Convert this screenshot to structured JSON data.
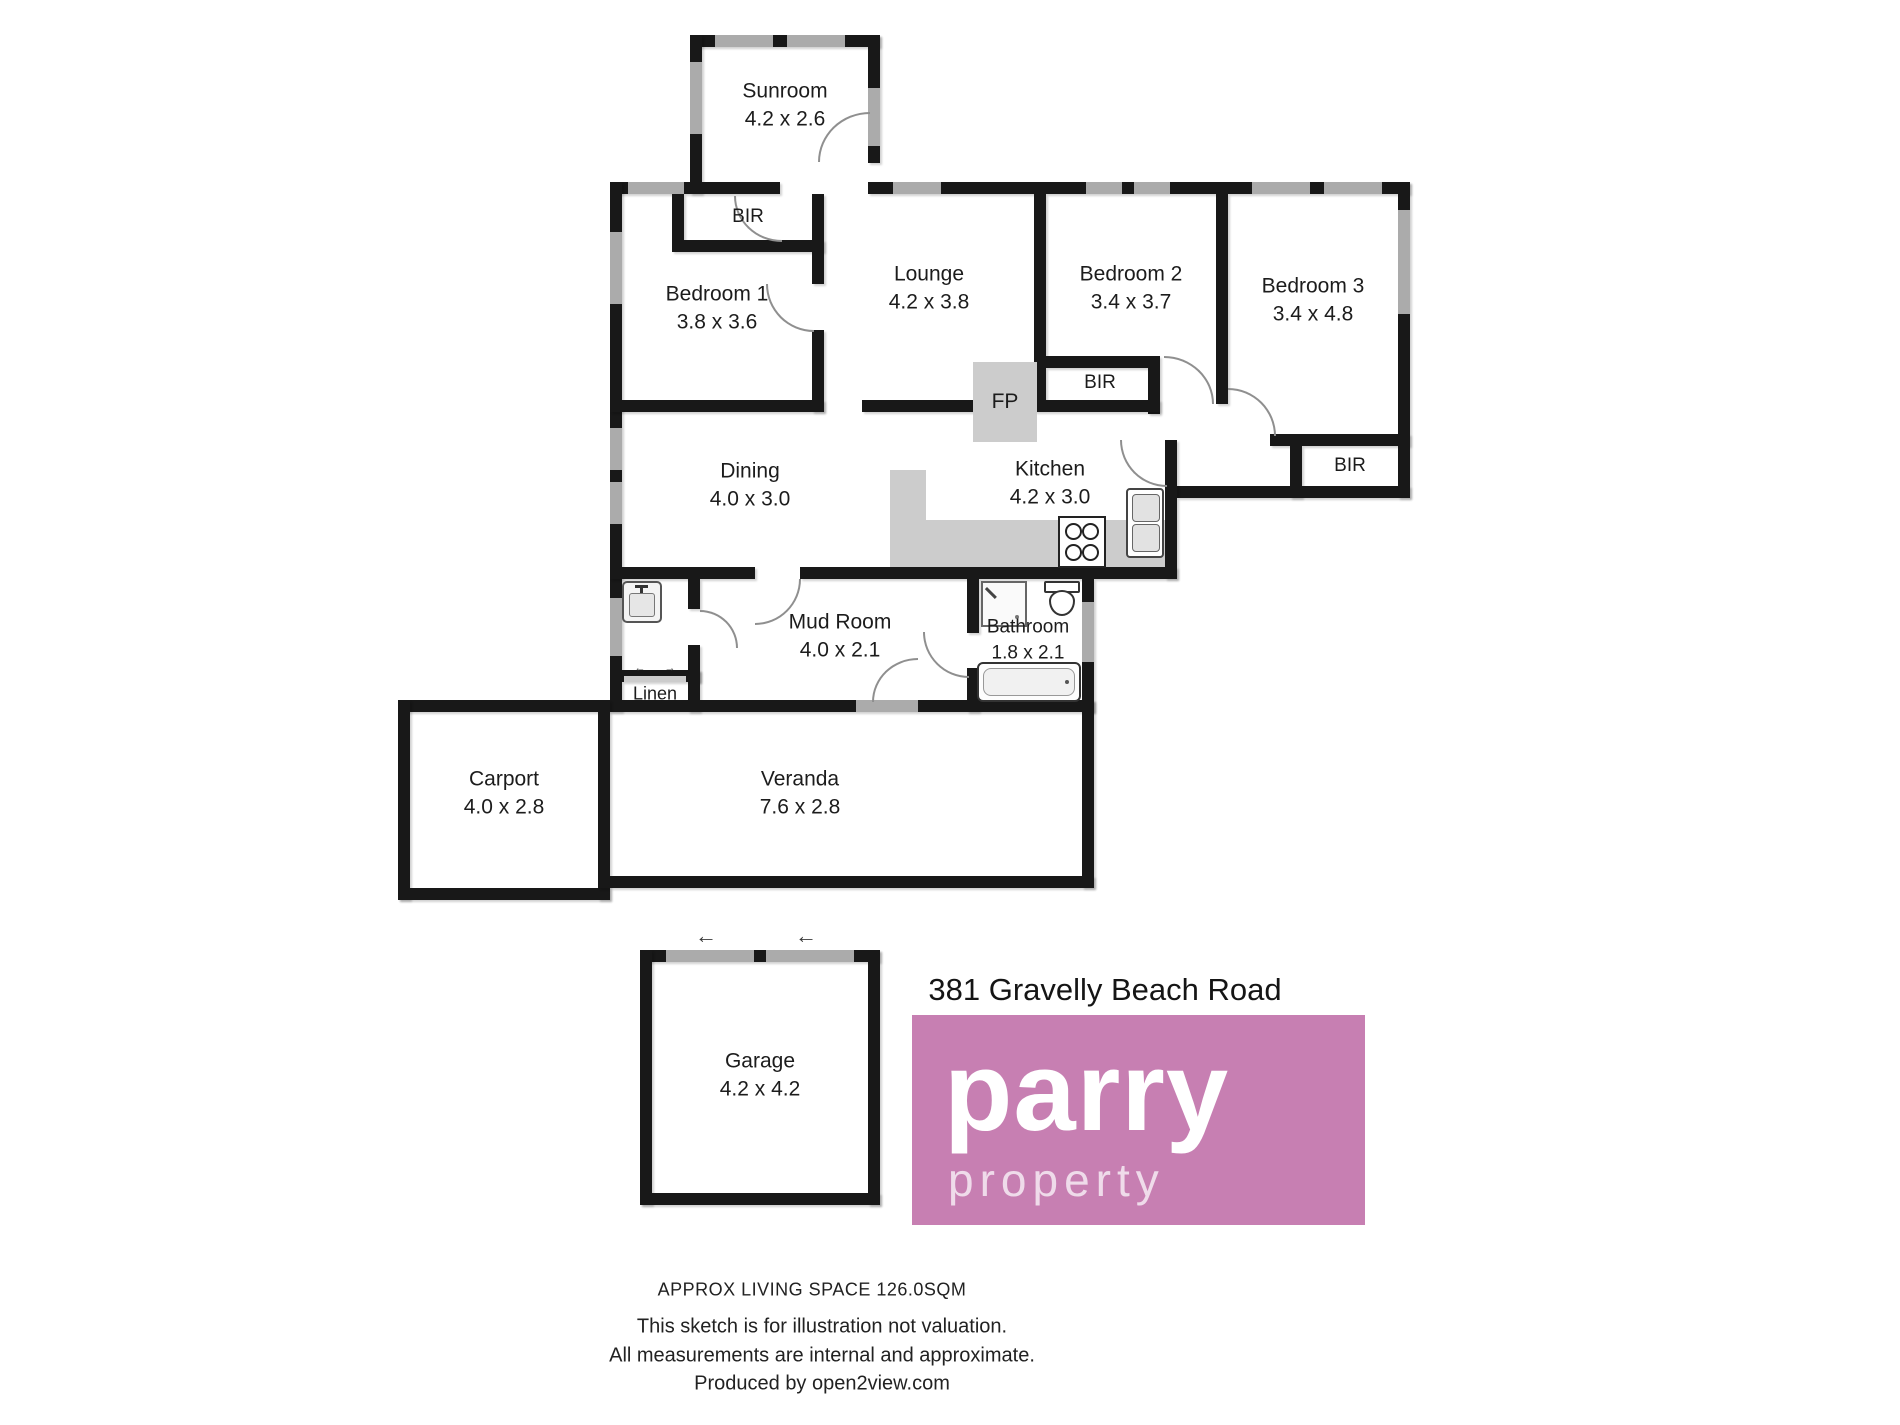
{
  "address": "381 Gravelly Beach Road",
  "brand": {
    "line1": "parry",
    "line2": "property",
    "pink": "#c77fb2"
  },
  "rooms": {
    "sunroom": {
      "name": "Sunroom",
      "dims": "4.2 x 2.6"
    },
    "bedroom1": {
      "name": "Bedroom 1",
      "dims": "3.8 x 3.6"
    },
    "lounge": {
      "name": "Lounge",
      "dims": "4.2 x 3.8"
    },
    "bedroom2": {
      "name": "Bedroom 2",
      "dims": "3.4 x 3.7"
    },
    "bedroom3": {
      "name": "Bedroom 3",
      "dims": "3.4 x 4.8"
    },
    "dining": {
      "name": "Dining",
      "dims": "4.0 x 3.0"
    },
    "kitchen": {
      "name": "Kitchen",
      "dims": "4.2 x 3.0"
    },
    "mudroom": {
      "name": "Mud Room",
      "dims": "4.0 x 2.1"
    },
    "bathroom": {
      "name": "Bathroom",
      "dims": "1.8 x 2.1"
    },
    "carport": {
      "name": "Carport",
      "dims": "4.0 x 2.8"
    },
    "veranda": {
      "name": "Veranda",
      "dims": "7.6 x 2.8"
    },
    "garage": {
      "name": "Garage",
      "dims": "4.2 x 4.2"
    }
  },
  "closets": {
    "bir1": "BIR",
    "bir2": "BIR",
    "bir3": "BIR",
    "linen": "Linen",
    "fireplace": "FP"
  },
  "footer": {
    "living_space": "APPROX LIVING SPACE 126.0SQM",
    "line1": "This sketch is for illustration not valuation.",
    "line2": "All measurements are internal and approximate.",
    "line3": "Produced by open2view.com"
  },
  "colors": {
    "wall": "#181818",
    "window": "#ababab",
    "fixture": "#cccccc"
  }
}
